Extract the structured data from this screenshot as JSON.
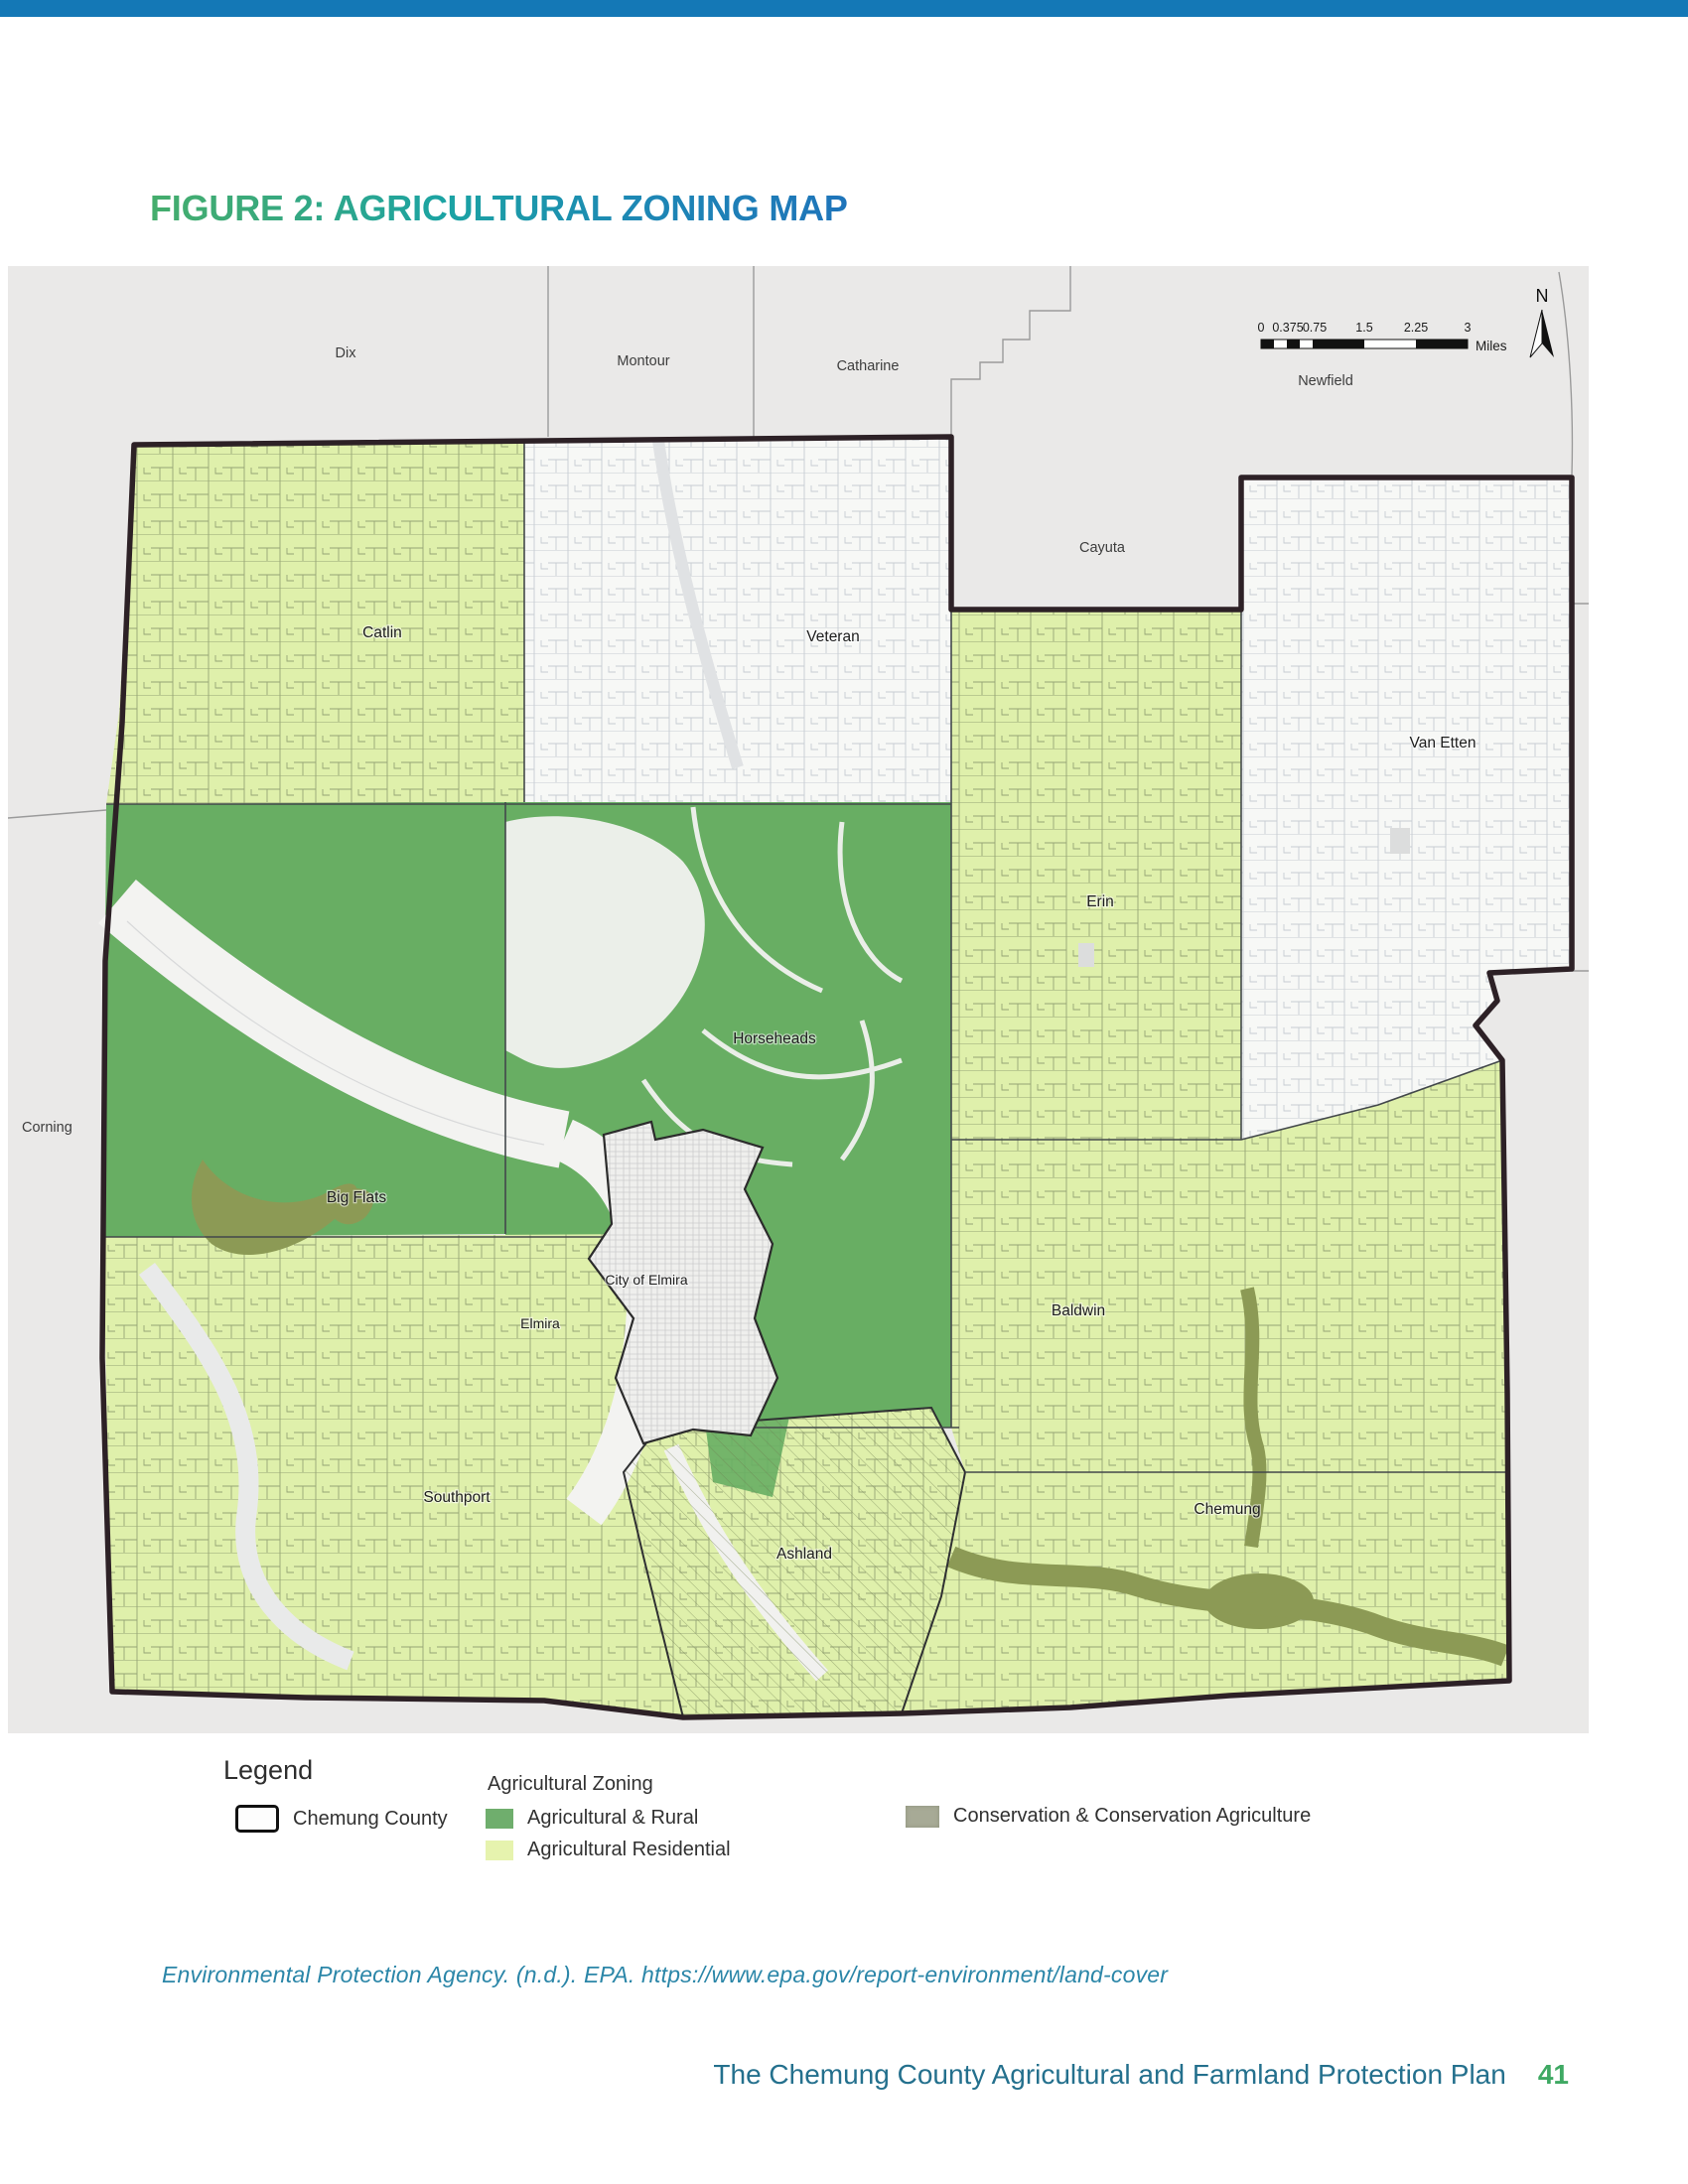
{
  "page": {
    "title": "FIGURE 2: AGRICULTURAL ZONING MAP",
    "top_bar_color": "#1478b6",
    "citation": "Environmental Protection Agency. (n.d.). EPA. https://www.epa.gov/report-environment/land-cover",
    "footer": {
      "text": "The Chemung County Agricultural and Farmland Protection Plan",
      "page_number": "41"
    }
  },
  "map": {
    "compass_label": "N",
    "scale_bar": {
      "tick_labels": [
        "0",
        "0.375",
        "0.75",
        "1.5",
        "2.25",
        "3"
      ],
      "unit": "Miles"
    },
    "outside_towns": [
      {
        "name": "Dix"
      },
      {
        "name": "Montour"
      },
      {
        "name": "Catharine"
      },
      {
        "name": "Newfield"
      },
      {
        "name": "Cayuta"
      },
      {
        "name": "Corning"
      }
    ],
    "county_towns": [
      {
        "name": "Catlin"
      },
      {
        "name": "Veteran"
      },
      {
        "name": "Van Etten"
      },
      {
        "name": "Erin"
      },
      {
        "name": "Horseheads"
      },
      {
        "name": "Big Flats"
      },
      {
        "name": "City of Elmira"
      },
      {
        "name": "Elmira"
      },
      {
        "name": "Baldwin"
      },
      {
        "name": "Southport"
      },
      {
        "name": "Ashland"
      },
      {
        "name": "Chemung"
      }
    ],
    "colors": {
      "agricultural_rural": "#68ae63",
      "agricultural_residential": "#dff0ab",
      "conservation": "#8c9a55",
      "outside_area": "#eae9e8",
      "county_border": "#2d2126"
    }
  },
  "legend": {
    "heading": "Legend",
    "county_label": "Chemung County",
    "zoning_heading": "Agricultural Zoning",
    "items": [
      {
        "label": "Agricultural & Rural",
        "color": "#6fae6d"
      },
      {
        "label": "Agricultural Residential",
        "color": "#e6f3ae"
      },
      {
        "label": "Conservation & Conservation Agriculture",
        "color": "#a7aa96"
      }
    ]
  }
}
